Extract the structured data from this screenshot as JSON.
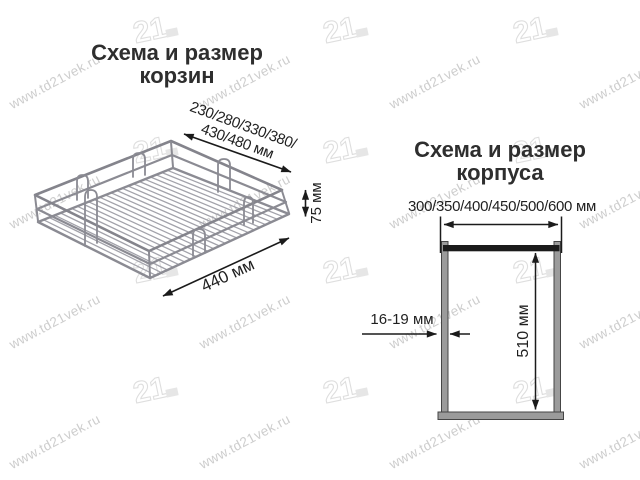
{
  "watermark": {
    "url_text": "www.td21vek.ru",
    "logo_text": "21"
  },
  "basket_section": {
    "title_line1": "Схема и размер",
    "title_line2": "корзин",
    "width_label_line1": "230/280/330/380/",
    "width_label_line2": "430/480 мм",
    "height_label": "75 мм",
    "depth_label": "440 мм"
  },
  "cabinet_section": {
    "title_line1": "Схема и размер",
    "title_line2": "корпуса",
    "width_label": "300/350/400/450/500/600 мм",
    "panel_thickness_label": "16-19 мм",
    "height_label": "510 мм"
  },
  "colors": {
    "title_text": "#2e2e2e",
    "dimension_text": "#1f1f1f",
    "dimension_line": "#1b1b1b",
    "wire": "#8b8b93",
    "wire_light": "#a2a2aa",
    "panel_fill": "#9b9b9b",
    "panel_border": "#454545",
    "top_rail": "#1b1b1b",
    "watermark_text": "#cdcdcd",
    "watermark_logo": "#dedede",
    "background": "#ffffff"
  }
}
